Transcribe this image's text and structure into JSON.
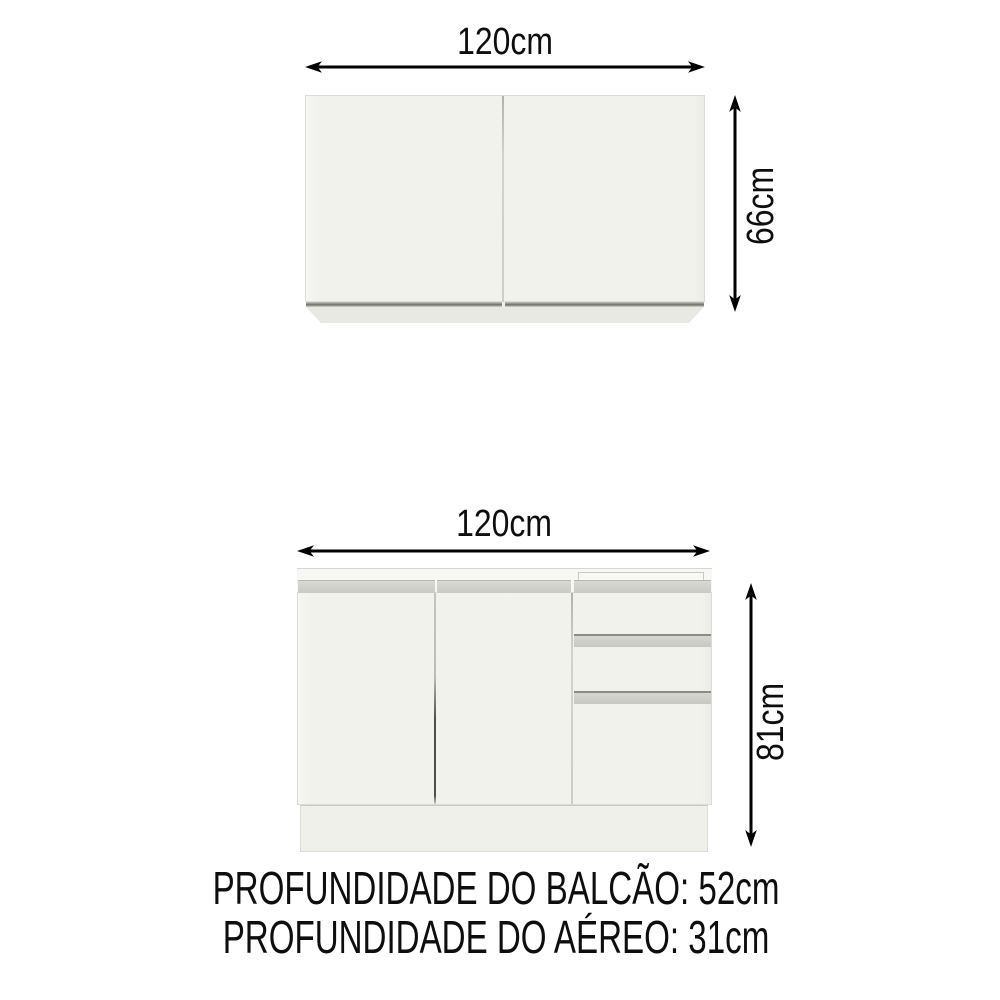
{
  "diagram": {
    "title": "kitchen-cabinet-dimensions",
    "upper_cabinet": {
      "name": "wall-cabinet-aereo",
      "doors_visible": 2,
      "width_label": "120cm",
      "height_label": "66cm"
    },
    "lower_cabinet": {
      "name": "counter-cabinet-balcao",
      "doors_visible": 3,
      "drawers_visible": 2,
      "width_label": "120cm",
      "height_label": "81cm"
    },
    "depth_notes": [
      {
        "text": "PROFUNDIDADE DO BALCÃO: 52cm"
      },
      {
        "text": "PROFUNDIDADE DO AÉREO: 31cm"
      }
    ]
  },
  "colors": {
    "background": "#ffffff",
    "cabinet_face": "#f2f2ed",
    "cabinet_edge": "#dcdcd6",
    "handle_strip": "#cdcec8",
    "handle_strip_dark": "#8a8d83",
    "upper_groove_dark": "#6e7267",
    "dimension_text": "#0e0e0e",
    "arrow": "#000000"
  }
}
